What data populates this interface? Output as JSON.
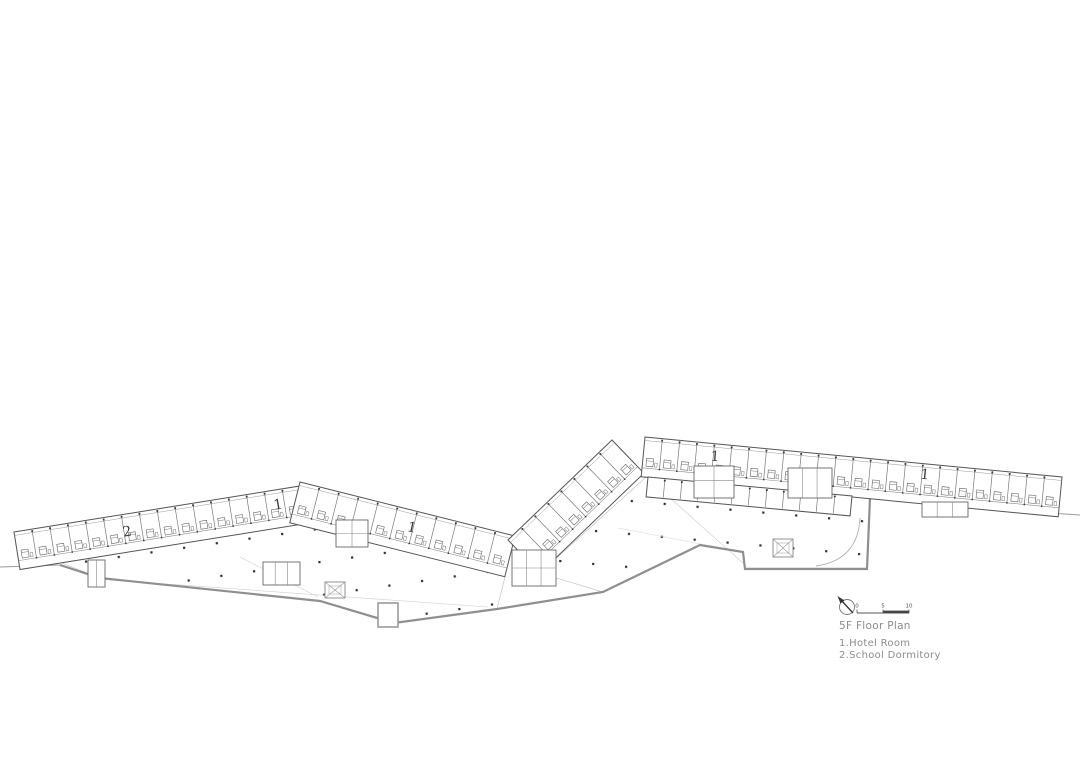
{
  "plan": {
    "title": "5F Floor Plan",
    "legend": [
      "1.Hotel Room",
      "2.School Dormitory"
    ],
    "room_labels": [
      {
        "room": "school-dormitory",
        "text": "2"
      },
      {
        "room": "hotel-room",
        "text": "1"
      },
      {
        "room": "hotel-room",
        "text": "1"
      },
      {
        "room": "hotel-room",
        "text": "1"
      },
      {
        "room": "hotel-room",
        "text": "1"
      }
    ],
    "scale": {
      "ticks": [
        "0",
        "5",
        "10"
      ]
    },
    "colors": {
      "ink": "#4a4a4a",
      "site_line": "#8f8f8f",
      "annotation_text": "#8c8c8c",
      "background": "#ffffff"
    }
  }
}
